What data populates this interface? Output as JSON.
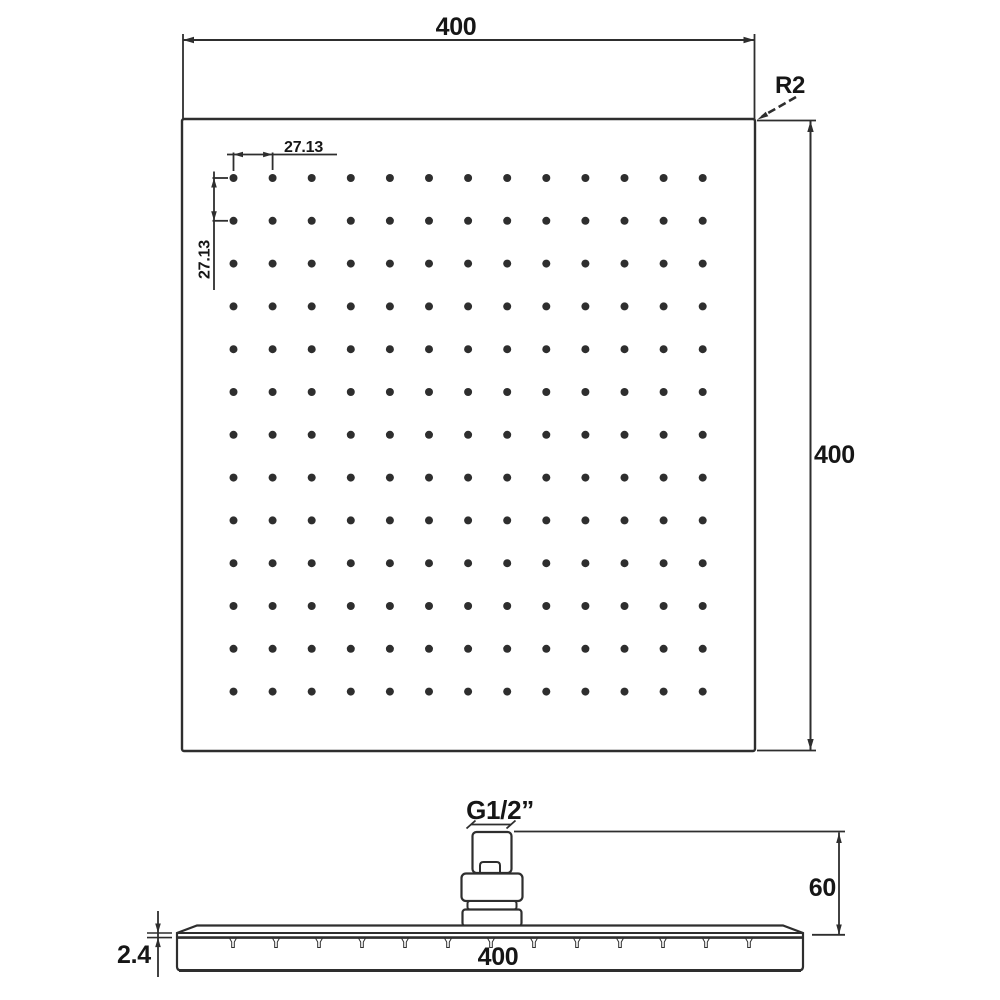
{
  "sheet": {
    "background": "#ffffff"
  },
  "colors": {
    "line": "#2e2e2e",
    "text": "#161616",
    "dot": "#2d2d2d"
  },
  "top_view": {
    "width_dim": "400",
    "height_dim": "400",
    "corner_radius": "R2",
    "hole_pitch_horizontal": "27.13",
    "hole_pitch_vertical": "27.13",
    "grid": {
      "rows": 13,
      "cols": 13,
      "x0": 233.5,
      "y0": 178,
      "dx": 39.1,
      "dy": 42.8,
      "dot_radius": 4
    }
  },
  "side_view": {
    "width_dim": "400",
    "plate_thickness_dim": "2.4",
    "connector_height_dim": "60",
    "thread_size": "G1/2”",
    "nozzles": {
      "count": 13,
      "x0": 233,
      "dx": 43
    }
  }
}
